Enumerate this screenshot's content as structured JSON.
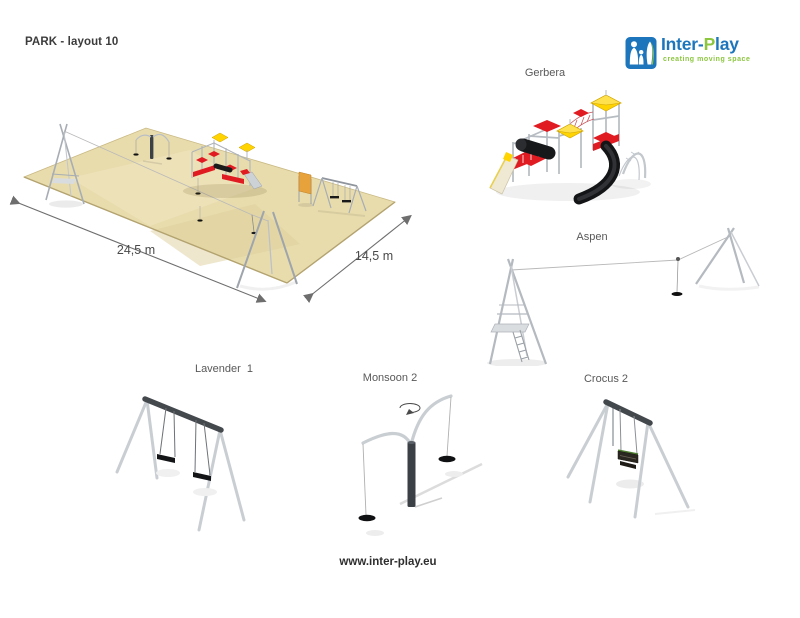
{
  "page": {
    "title": "PARK - layout 10",
    "footer_url": "www.inter-play.eu"
  },
  "logo": {
    "brand_pre": "Inter-",
    "brand_accent": "P",
    "brand_post": "lay",
    "tagline": "creating moving space",
    "blue": "#1d76bc",
    "green": "#8cc63f"
  },
  "site_plan": {
    "length_label": "24,5 m",
    "width_label": "14,5 m",
    "ground_color": "#e8dcad"
  },
  "products": [
    {
      "id": "gerbera",
      "name": "Gerbera"
    },
    {
      "id": "aspen",
      "name": "Aspen"
    },
    {
      "id": "lavender-1",
      "name": "Lavender  1"
    },
    {
      "id": "monsoon-2",
      "name": "Monsoon 2"
    },
    {
      "id": "crocus-2",
      "name": "Crocus 2"
    }
  ],
  "palette": {
    "red": "#e01b21",
    "yellow": "#ffd400",
    "frame_gray": "#b6bcc2",
    "dark_steel": "#43484d",
    "black": "#141517",
    "sand_edge": "#c9b983",
    "label_gray": "#595959",
    "arrow_gray": "#6e6e6e"
  }
}
